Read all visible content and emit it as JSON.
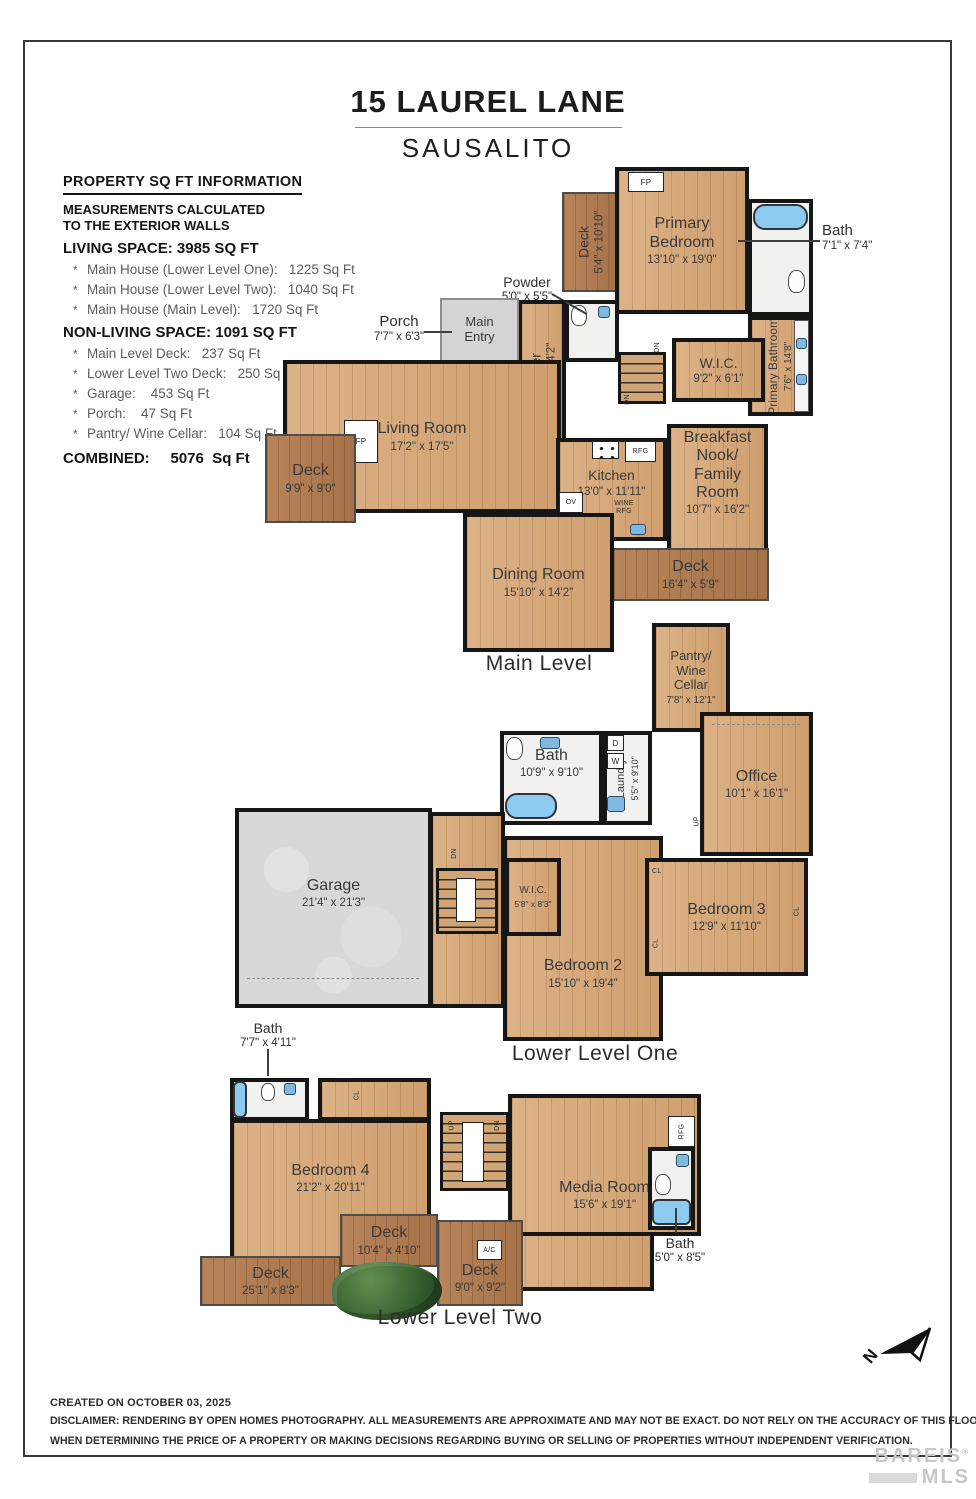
{
  "page": {
    "title": "15 LAUREL LANE",
    "subtitle": "SAUSALITO"
  },
  "info": {
    "heading": "PROPERTY SQ FT INFORMATION",
    "note_line1": "MEASUREMENTS CALCULATED",
    "note_line2": "TO THE EXTERIOR WALLS",
    "living_heading": "LIVING SPACE: 3985 SQ FT",
    "bullet": "*",
    "living_items": [
      "Main House (Lower Level One):   1225 Sq Ft",
      "Main House (Lower Level Two):   1040 Sq Ft",
      "Main House (Main Level):   1720 Sq Ft"
    ],
    "nonliving_heading": "NON-LIVING SPACE: 1091 SQ FT",
    "nonliving_items": [
      "Main Level Deck:   237 Sq Ft",
      "Lower Level Two Deck:   250 Sq Ft",
      "Garage:    453 Sq Ft",
      "Porch:    47 Sq Ft",
      "Pantry/ Wine Cellar:   104 Sq Ft"
    ],
    "combined": "COMBINED:     5076  Sq Ft"
  },
  "levels": {
    "main": {
      "caption": "Main Level",
      "rooms": {
        "deck_top": {
          "name": "Deck",
          "dims": "5'4\" x 10'10\""
        },
        "primary_bedroom": {
          "name": "Primary\nBedroom",
          "dims": "13'10\" x 19'0\""
        },
        "bath": {
          "name": "Bath",
          "dims": "7'1\" x 7'4\""
        },
        "primary_bathroom": {
          "name": "Primary Bathroom",
          "dims": "7'6\" x 14'8\""
        },
        "wic": {
          "name": "W.I.C.",
          "dims": "9'2\" x 6'1\""
        },
        "powder": {
          "name": "Powder",
          "dims": "5'0\" x 5'5\""
        },
        "foyer": {
          "name": "Foyer",
          "dims": "6'4\" x 14'2\""
        },
        "main_entry": {
          "name": "Main\nEntry"
        },
        "porch": {
          "name": "Porch",
          "dims": "7'7\" x 6'3\""
        },
        "living_room": {
          "name": "Living Room",
          "dims": "17'2\" x 17'5\""
        },
        "deck_left": {
          "name": "Deck",
          "dims": "9'9\" x 9'0\""
        },
        "kitchen": {
          "name": "Kitchen",
          "dims": "13'0\" x 11'11\""
        },
        "breakfast": {
          "name": "Breakfast\nNook/\nFamily Room",
          "dims": "10'7\" x 16'2\""
        },
        "deck_right": {
          "name": "Deck",
          "dims": "16'4\" x 5'9\""
        },
        "dining": {
          "name": "Dining Room",
          "dims": "15'10\" x 14'2\""
        }
      }
    },
    "lower1": {
      "caption": "Lower Level One",
      "rooms": {
        "pantry": {
          "name": "Pantry/\nWine\nCellar",
          "dims": "7'8\" x 12'1\""
        },
        "bath": {
          "name": "Bath",
          "dims": "10'9\" x 9'10\""
        },
        "laundry": {
          "name": "Laundry",
          "dims": "5'5\" x 9'10\""
        },
        "office": {
          "name": "Office",
          "dims": "10'1\" x 16'1\""
        },
        "garage": {
          "name": "Garage",
          "dims": "21'4\" x 21'3\""
        },
        "wic": {
          "name": "W.I.C.",
          "dims": "5'8\" x 8'3\""
        },
        "bedroom2": {
          "name": "Bedroom 2",
          "dims": "15'10\" x 19'4\""
        },
        "bedroom3": {
          "name": "Bedroom 3",
          "dims": "12'9\" x 11'10\""
        }
      }
    },
    "lower2": {
      "caption": "Lower Level Two",
      "rooms": {
        "bath_left": {
          "name": "Bath",
          "dims": "7'7\" x 4'11\""
        },
        "bedroom4": {
          "name": "Bedroom 4",
          "dims": "21'2\" x 20'11\""
        },
        "media_room": {
          "name": "Media Room",
          "dims": "15'6\" x 19'1\""
        },
        "deck_upper": {
          "name": "Deck",
          "dims": "10'4\" x 4'10\""
        },
        "deck_lower": {
          "name": "Deck",
          "dims": "25'1\" x 8'3\""
        },
        "deck_right": {
          "name": "Deck",
          "dims": "9'0\" x 9'2\""
        },
        "bath_right": {
          "name": "Bath",
          "dims": "5'0\" x 8'5\""
        }
      }
    }
  },
  "markers": {
    "fp": "FP",
    "rfg": "RFG",
    "ov": "OV",
    "wine_rfg": "WINE RFG",
    "dn": "DN",
    "up": "UP",
    "cl": "CL",
    "ac": "A/C",
    "d": "D",
    "w": "W"
  },
  "compass": {
    "label": "N"
  },
  "footer": {
    "created": "CREATED ON OCTOBER 03, 2025",
    "disclaimer_line1": "DISCLAIMER: RENDERING BY OPEN HOMES PHOTOGRAPHY. ALL MEASUREMENTS ARE APPROXIMATE AND MAY NOT BE EXACT. DO NOT RELY ON THE ACCURACY OF THIS FLOOR PLAN",
    "disclaimer_line2": "WHEN DETERMINING THE PRICE OF A PROPERTY OR MAKING DECISIONS REGARDING BUYING OR SELLING OF PROPERTIES WITHOUT INDEPENDENT VERIFICATION."
  },
  "watermark": {
    "line1": "BAREIS",
    "reg": "®",
    "line2": "MLS"
  }
}
